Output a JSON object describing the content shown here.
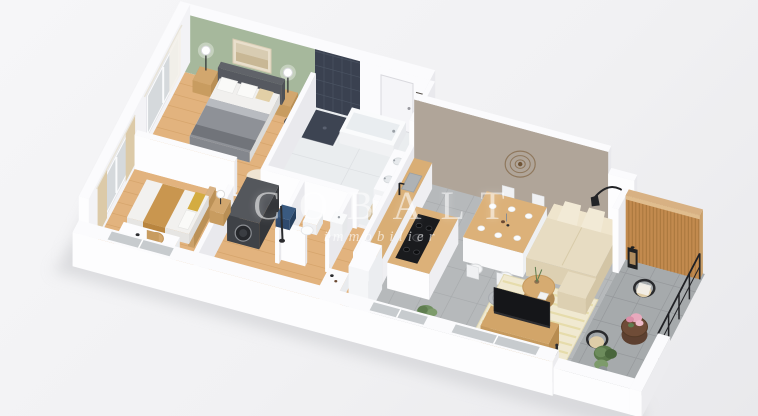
{
  "watermark": {
    "title": "COBALT",
    "subtitle": "immobilier"
  },
  "colors": {
    "background_top": "#f6f6f8",
    "background_bottom": "#e9e9ec",
    "shadow": "#c9cace",
    "wall_white_top": "#fbfbfd",
    "wall_white_face": "#fdfdfe",
    "wall_white_side": "#e9e9ed",
    "wall_interior_west": "#f3f3f6",
    "accent_green": "#a6b89c",
    "accent_taupe": "#b0a599",
    "bathroom_tile_navy": "#3a4150",
    "bathroom_tile_line": "#4a5362",
    "balcony_wood_slats": "#c28a4e",
    "balcony_slat_line": "#a06f38",
    "floor_wood": "#e2b37e",
    "floor_wood_line": "#d2a066",
    "floor_tile_grey": "#b6b9bb",
    "floor_tile_line": "#a9acae",
    "floor_balcony": "#a6aaac",
    "floor_bathroom": "#eaedef",
    "sofa_beige": "#e7dcc2",
    "rug_cream": "#f0e9d1",
    "rug_stripe": "#e4d9a2",
    "furniture_wood": "#d2a569",
    "bedding_grey": "#8e9197",
    "throw_caramel": "#c9964f",
    "pillow_mustard": "#d4ac41",
    "tv_black": "#151619",
    "plant_green": "#6d8c5c",
    "flower_pink": "#e8a9bd",
    "metal_black": "#26272b",
    "curtain_beige": "#dccaa8",
    "glass_grey": "#d5d9dc",
    "watermark_white": "#ffffff"
  }
}
